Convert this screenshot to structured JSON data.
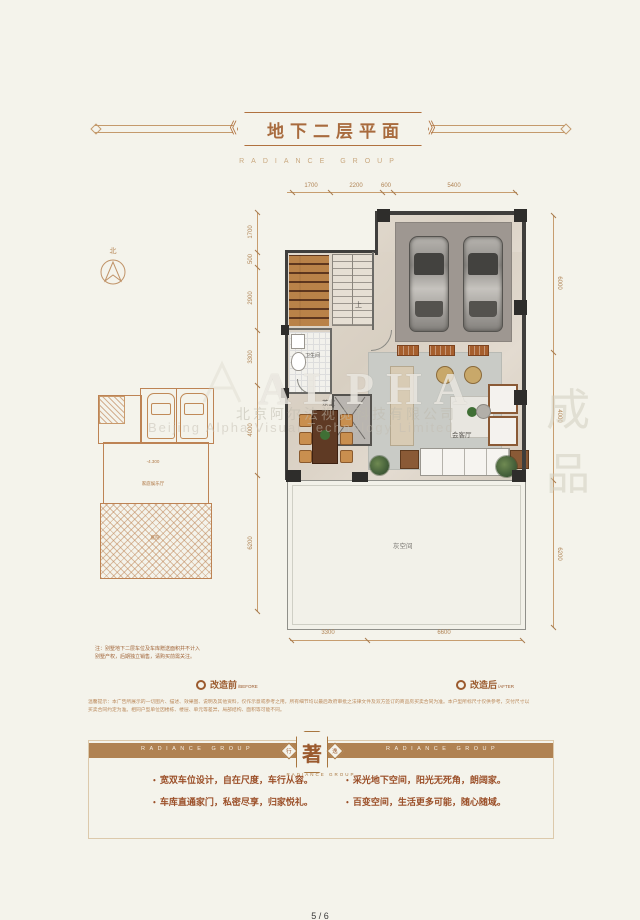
{
  "page": {
    "page_number": "5 / 6"
  },
  "header": {
    "title": "地下二层平面",
    "subtitle": "RADIANCE GROUP"
  },
  "compass": {
    "north": "北"
  },
  "main_plan": {
    "labels": {
      "stairs_up": "上",
      "bathroom": "卫生间",
      "tea_room": "茶室",
      "living_room": "会客厅",
      "grey_space": "灰空间"
    },
    "dims_top": [
      "1700",
      "2200",
      "600",
      "5400"
    ],
    "dims_left": [
      "1700",
      "500",
      "2900",
      "3300",
      "4000",
      "6200"
    ],
    "dims_right": [
      "6000",
      "4000",
      "6200"
    ],
    "dims_bottom": [
      "3300",
      "6600"
    ]
  },
  "before_plan": {
    "elevation": "-4.300",
    "room": "家庭娱乐厅",
    "terrace": "庭院"
  },
  "note": {
    "line1": "注：别墅地下二层车位及车库赠送面积并不计入",
    "line2": "别墅产权，后期独立销售，请购买前需关注。"
  },
  "legend": {
    "before_cn": "改造前",
    "before_en": "/BEFORE",
    "after_cn": "改造后",
    "after_en": "/AFTER"
  },
  "disclaimer": {
    "line1": "温馨提示：本广告所展示的一切图片、描述、效果图、说明及其他资料，仅作示意或参考之用，所有细节均以最后政府审批之法律文件及双方签订的商品房买卖合同为准。本户型所标尺寸仅供参考，交付尺寸以",
    "line2": "买卖合同约定为准。相同户型单位因楼栋、楼层、单元等差异，局部结构、面积等可能不同。"
  },
  "banner": {
    "group_left": "RADIANCE GROUP",
    "group_right": "RADIANCE GROUP",
    "badge_main": "著",
    "badge_left": "行",
    "badge_right": "逸",
    "badge_sub": "RADIANCE GROUP",
    "chev_left": "《",
    "chev_right": "》"
  },
  "features": [
    "宽双车位设计，自在尺度，车行从容。",
    "采光地下空间，阳光无死角，朗阔家。",
    "车库直通家门，私密尽享，归家悦礼。",
    "百变空间，生活更多可能，随心随域。"
  ],
  "watermark": {
    "brand": "ALPHA",
    "company_cn": "北京阿尔法视觉科技有限公司",
    "company_en": "Beijing Alpha Visual Technology Limited",
    "stamp": "成品"
  },
  "colors": {
    "accent": "#ab7344",
    "banner": "#b08252",
    "wall": "#3f3e3c"
  }
}
